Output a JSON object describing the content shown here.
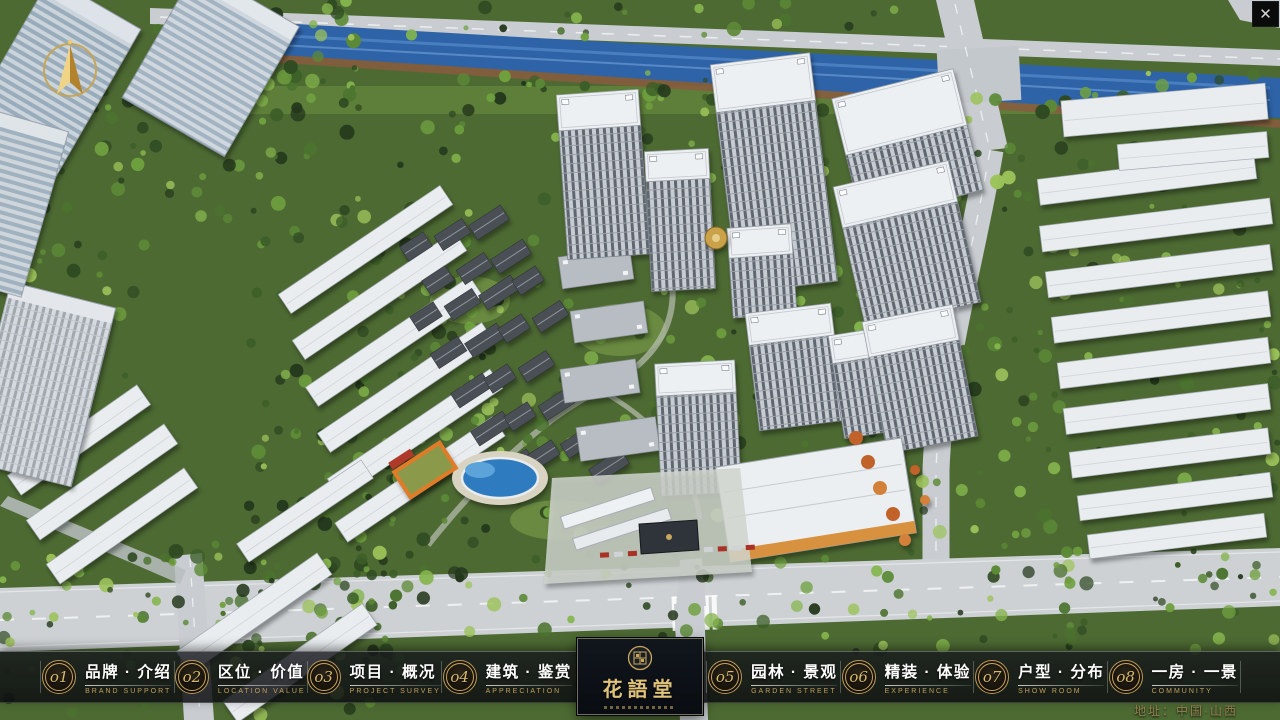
{
  "window": {
    "close_label": "✕"
  },
  "nav": {
    "items": [
      {
        "num": "o1",
        "zh": "品牌 · 介绍",
        "en": "BRAND SUPPORT"
      },
      {
        "num": "o2",
        "zh": "区位 · 价值",
        "en": "LOCATION VALUE"
      },
      {
        "num": "o3",
        "zh": "项目 · 概况",
        "en": "PROJECT SURVEY"
      },
      {
        "num": "o4",
        "zh": "建筑 · 鉴赏",
        "en": "APPRECIATION"
      },
      {
        "num": "o5",
        "zh": "园林 · 景观",
        "en": "GARDEN STREET"
      },
      {
        "num": "o6",
        "zh": "精装 · 体验",
        "en": "EXPERIENCE"
      },
      {
        "num": "o7",
        "zh": "户型 · 分布",
        "en": "SHOW ROOM"
      },
      {
        "num": "o8",
        "zh": "一房 · 一景",
        "en": "COMMUNITY"
      }
    ],
    "logo": {
      "title": "花語堂"
    },
    "address": "地址：中国·山西"
  },
  "colors": {
    "accent_gold": "#c9a85c",
    "bar_background": "rgba(16,18,22,0.82)",
    "chinese_label": "#ffffff",
    "english_label": "#bfa05e",
    "river": "#2e63a8",
    "road": "#c9cdd1",
    "foliage_dark": "#2f4a22",
    "foliage_light": "#84b44c"
  }
}
